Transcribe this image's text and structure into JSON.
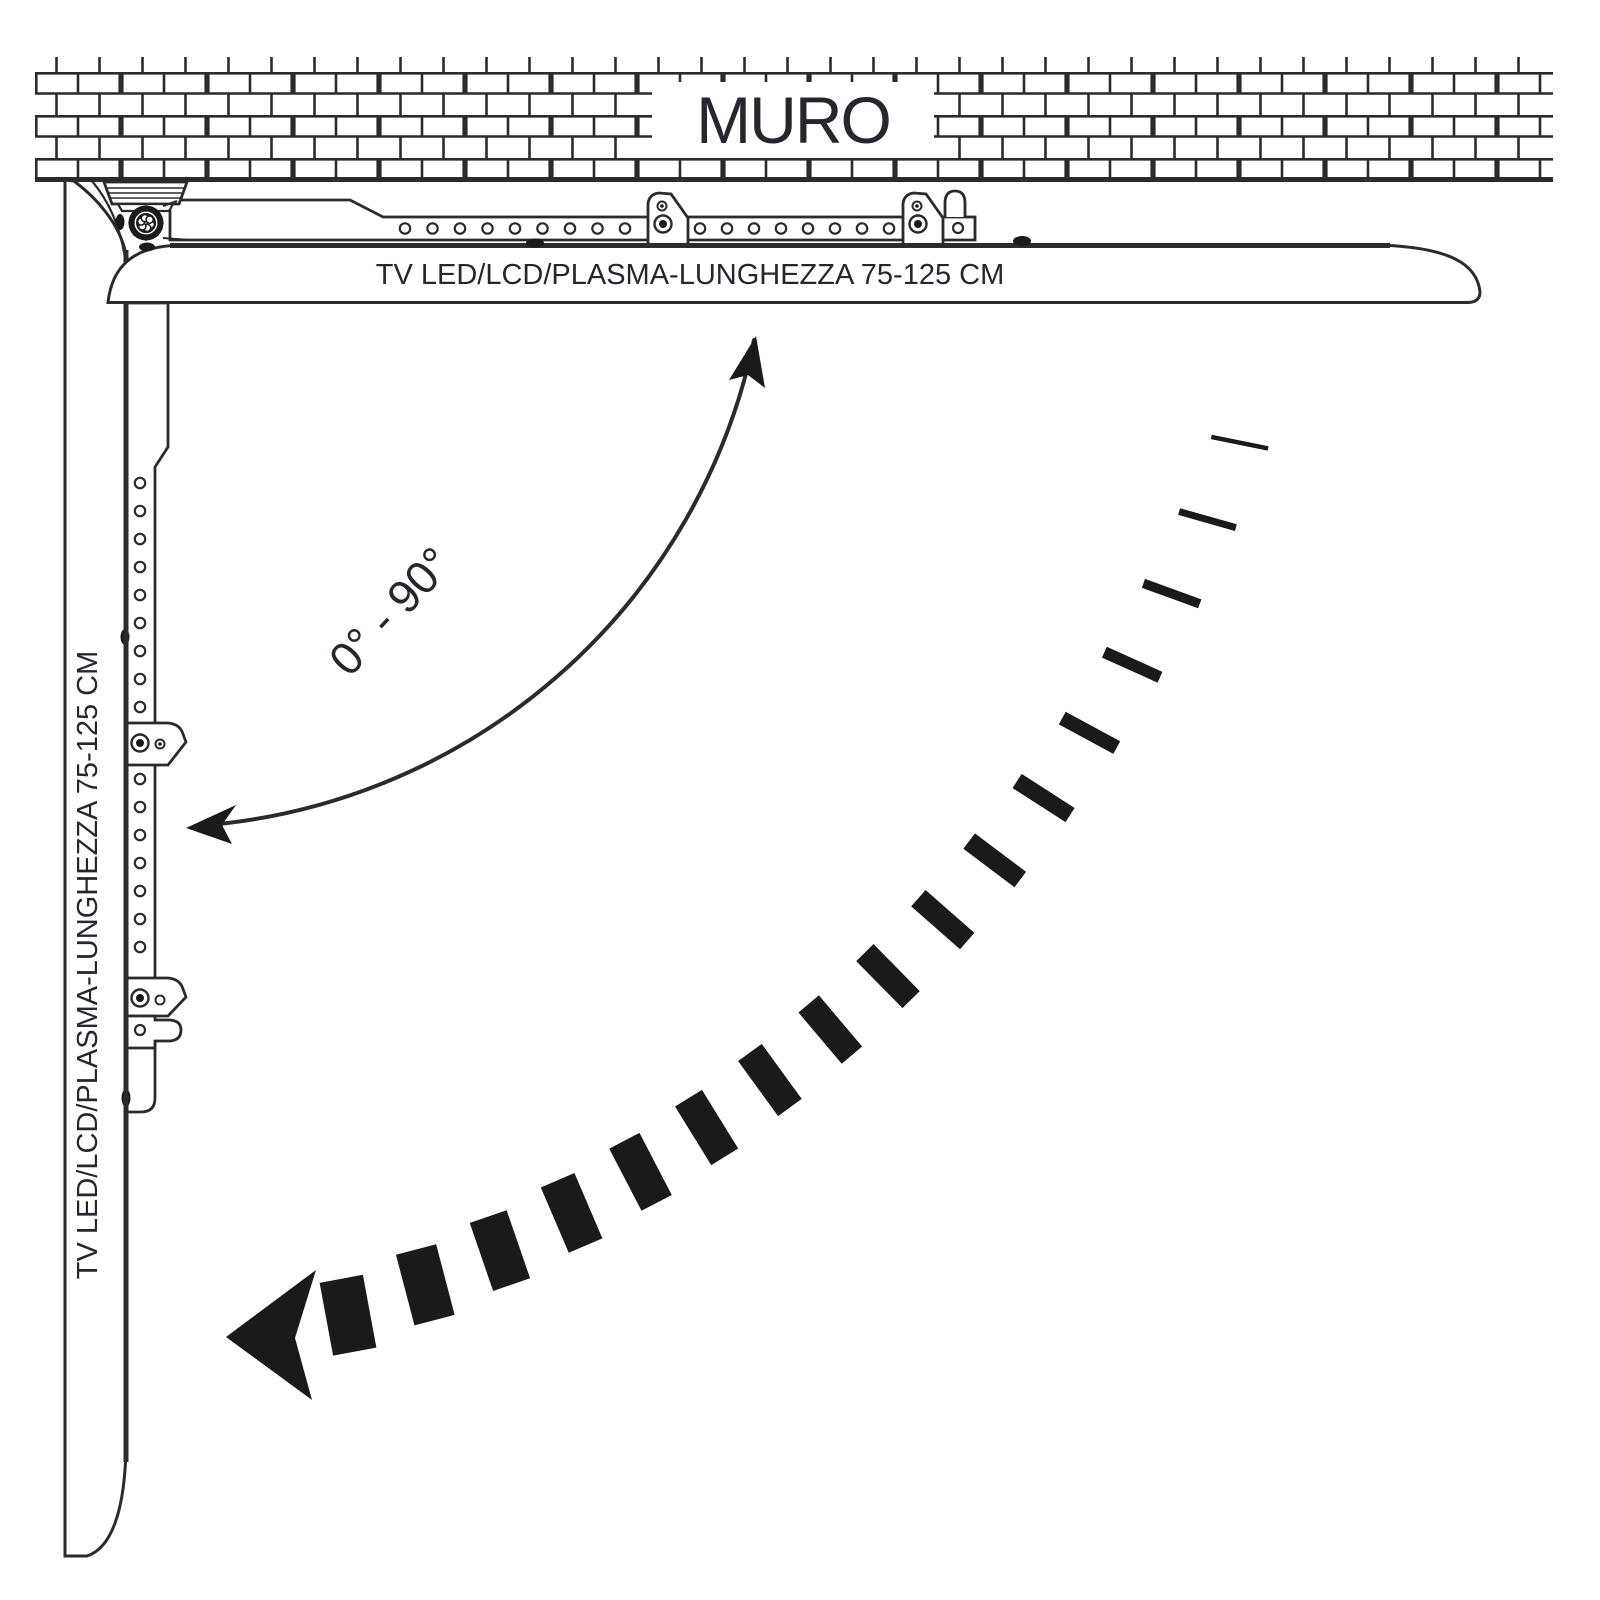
{
  "wall": {
    "label": "MURO"
  },
  "tv_horizontal": {
    "label": "TV LED/LCD/PLASMA-LUNGHEZZA 75-125 CM"
  },
  "tv_vertical": {
    "label": "TV LED/LCD/PLASMA-LUNGHEZZA 75-125 CM"
  },
  "rotation": {
    "angle_label": "0° - 90°"
  },
  "colors": {
    "line": "#2b2b2b",
    "text": "#26262e",
    "black_fill": "#1a1a1a",
    "background": "#ffffff"
  }
}
